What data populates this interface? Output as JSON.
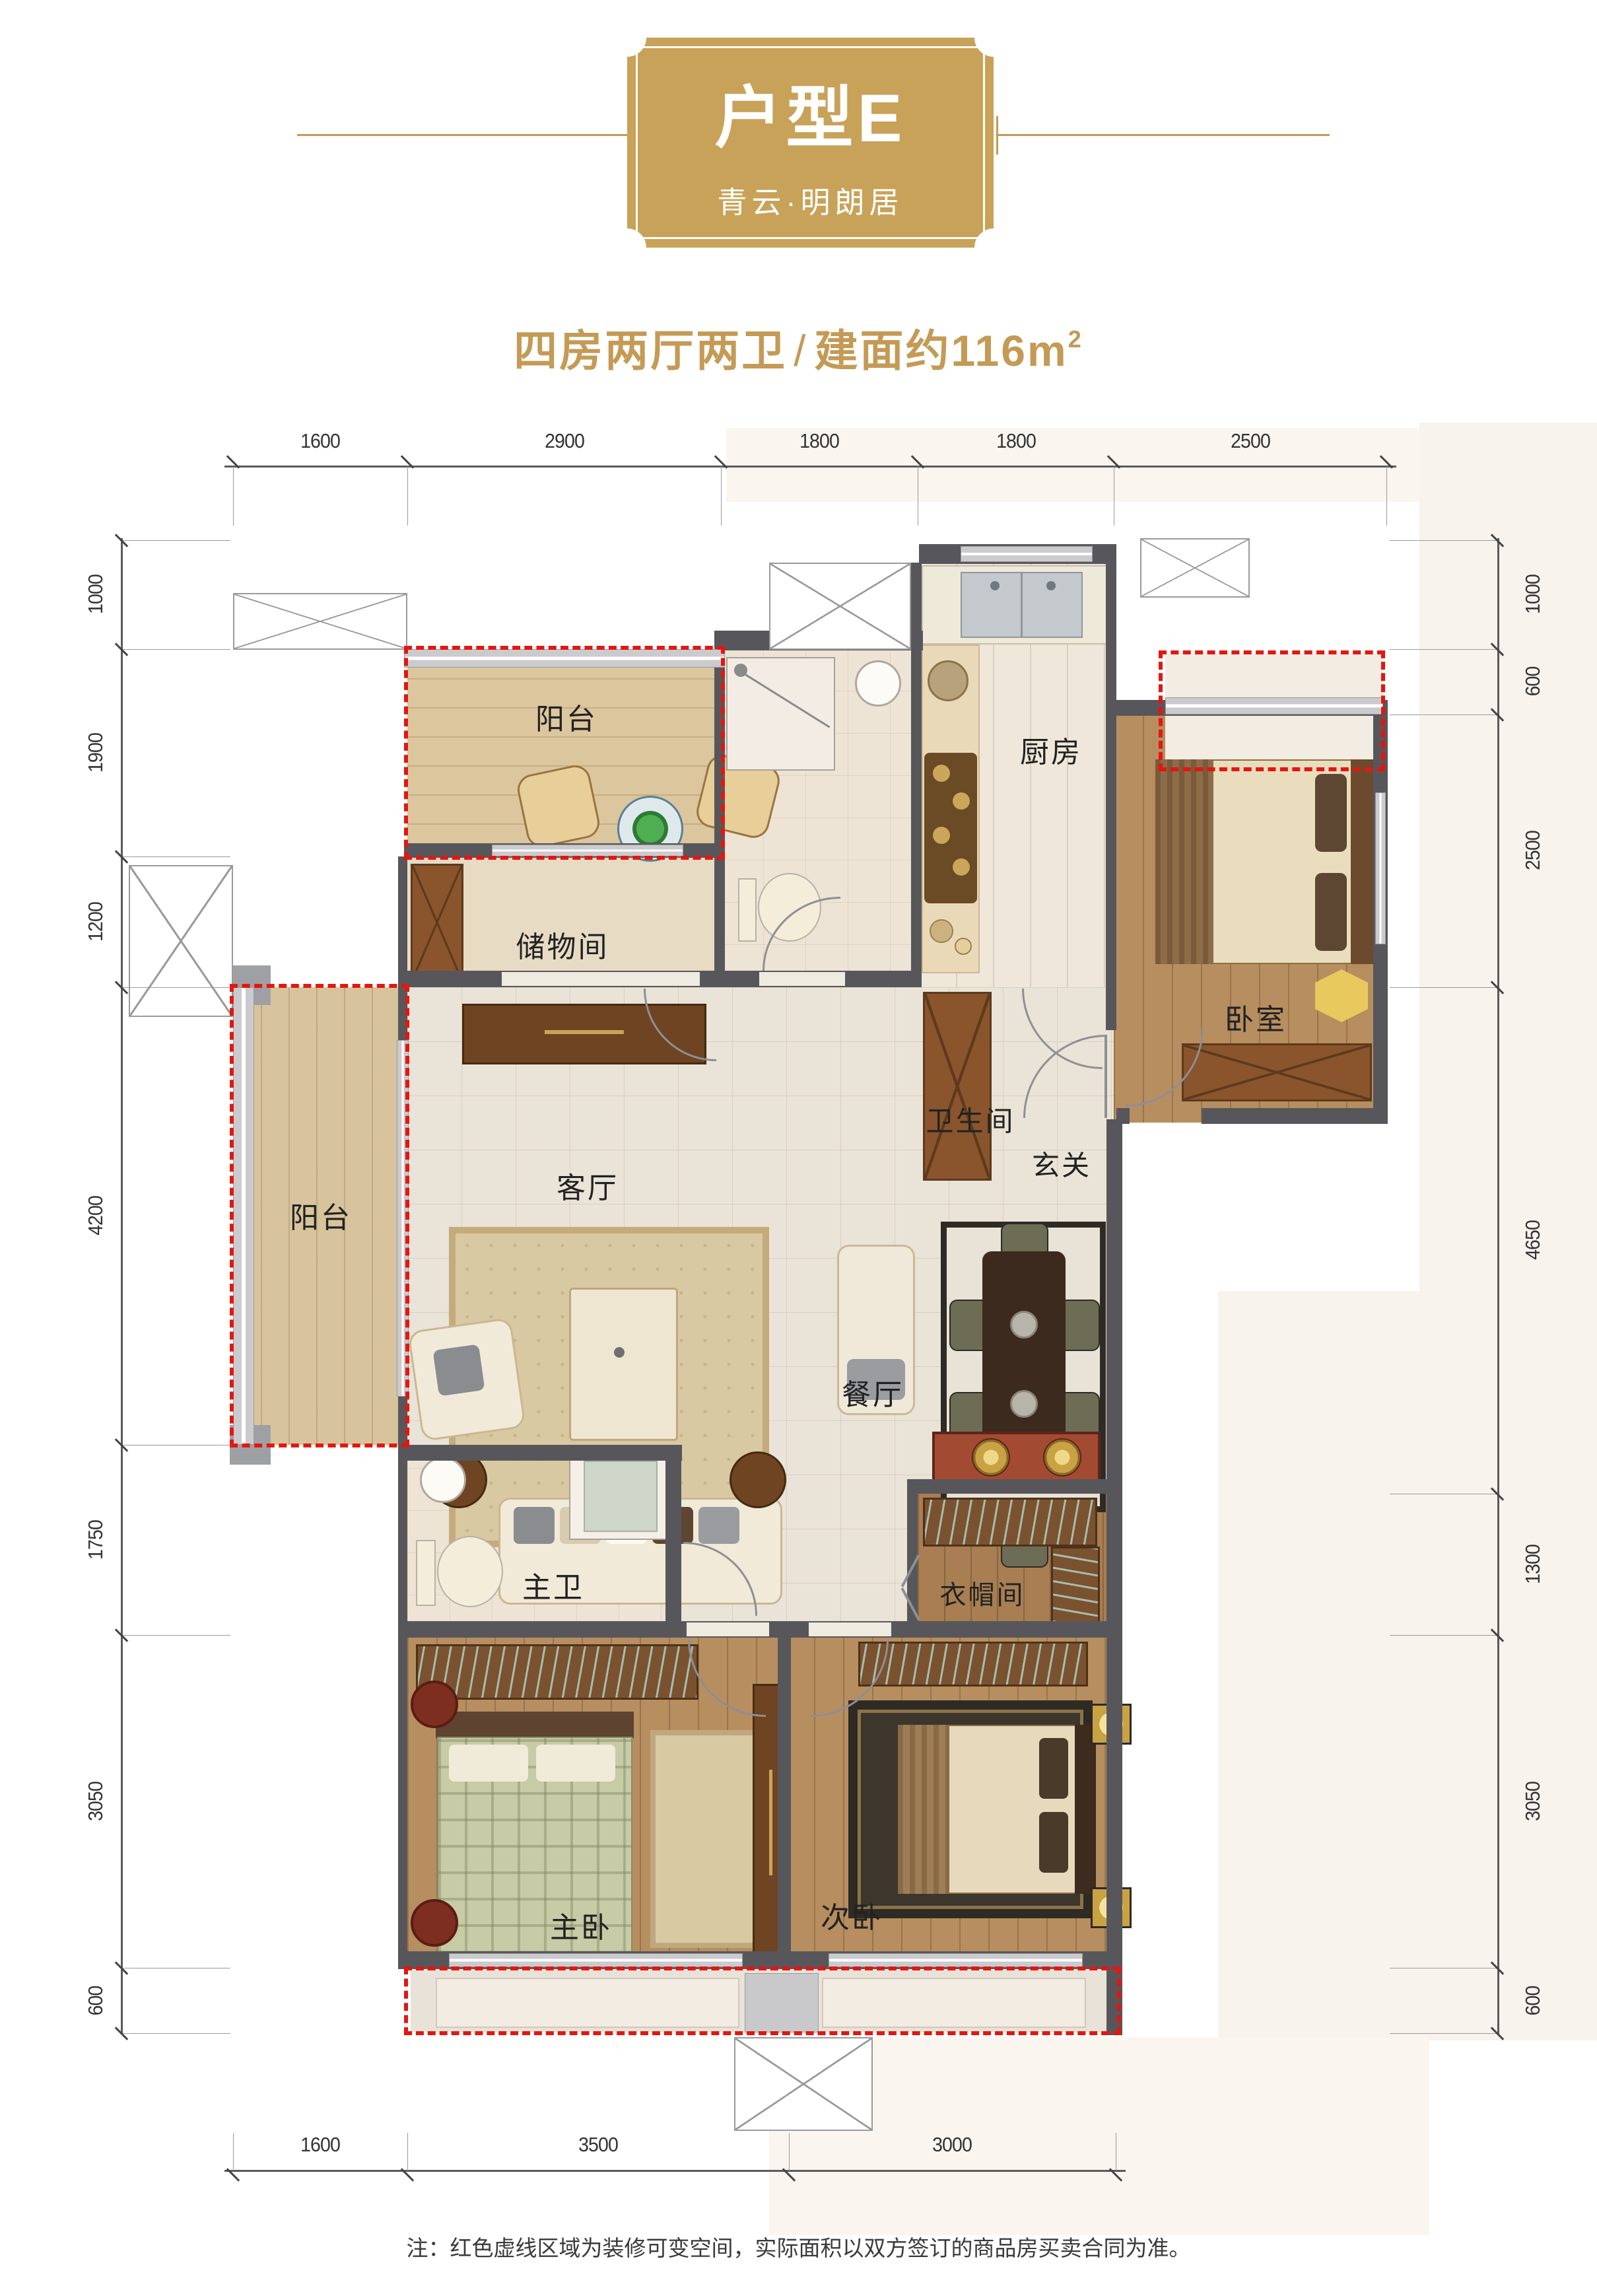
{
  "badge": {
    "title": "户型E",
    "subtitle": "青云·明朗居"
  },
  "headline": {
    "rooms": "四房两厅两卫",
    "separator": "/",
    "area": "建面约116m",
    "area_sup": "2"
  },
  "rooms": {
    "balcony_top": "阳台",
    "storage": "储物间",
    "bathroom": "卫生间",
    "kitchen": "厨房",
    "bedroom": "卧室",
    "living_room": "客厅",
    "foyer": "玄关",
    "dining_room": "餐厅",
    "balcony_left": "阳台",
    "master_bathroom": "主卫",
    "cloakroom": "衣帽间",
    "master_bedroom": "主卧",
    "second_bedroom": "次卧"
  },
  "dimensions": {
    "top": [
      "1600",
      "2900",
      "1800",
      "1800",
      "2500"
    ],
    "left": [
      "1000",
      "1900",
      "1200",
      "4200",
      "1750",
      "3050",
      "600"
    ],
    "right": [
      "1000",
      "600",
      "2500",
      "4650",
      "1300",
      "3050",
      "600"
    ],
    "bottom": [
      "1600",
      "3500",
      "3000"
    ]
  },
  "footnote": "注：红色虚线区域为装修可变空间，实际面积以双方签订的商品房买卖合同为准。",
  "colors": {
    "gold": "#c49a55",
    "red_dashed": "#e2170f",
    "wall": "#57575b"
  }
}
